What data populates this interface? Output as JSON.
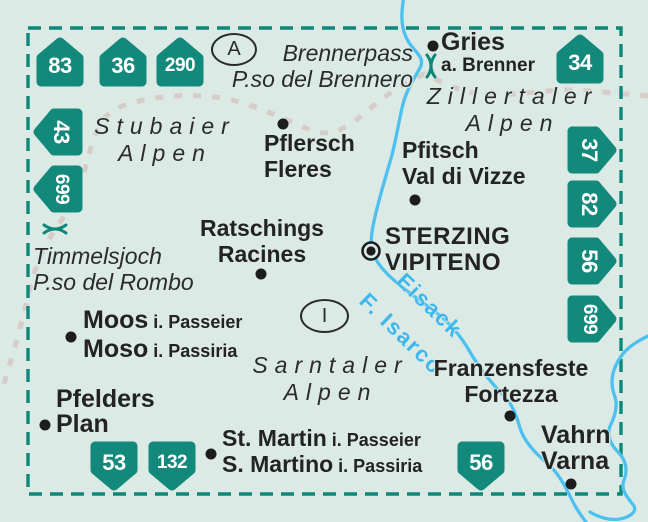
{
  "map_type": "kompass-sheet-overview-map",
  "colors": {
    "background": "#dceae6",
    "badge_green": "#12897b",
    "border_teal": "#0e8678",
    "river_blue": "#4cc1ef",
    "river_label_blue": "#3db7ec",
    "ridge_gray": "#d7cdc8",
    "text_dark": "#232323"
  },
  "badges": [
    {
      "number": "83"
    },
    {
      "number": "36"
    },
    {
      "number": "290"
    },
    {
      "number": "34"
    },
    {
      "number": "43"
    },
    {
      "number": "699"
    },
    {
      "number": "37"
    },
    {
      "number": "82"
    },
    {
      "number": "56"
    },
    {
      "number": "699"
    },
    {
      "number": "53"
    },
    {
      "number": "132"
    },
    {
      "number": "56"
    }
  ],
  "country_markers": {
    "austria": "A",
    "italy": "I"
  },
  "mountain_ranges": {
    "stubaier": {
      "line1": "Stubaier",
      "line2": "Alpen"
    },
    "zillertaler": {
      "line1": "Zillertaler",
      "line2": "Alpen"
    },
    "sarntaler": {
      "line1": "Sarntaler",
      "line2": "Alpen"
    }
  },
  "passes": {
    "brenner": {
      "line1": "Brennerpass",
      "line2": "P.so del Brennero"
    },
    "timmelsjoch": {
      "line1": "Timmelsjoch",
      "line2": "P.so del Rombo"
    }
  },
  "rivers": {
    "name_de": "Eisack",
    "name_it": "F. Isarco"
  },
  "places": {
    "gries": {
      "line1": "Gries",
      "line2": "a. Brenner"
    },
    "pflersch": {
      "line1": "Pflersch",
      "line2": "Fleres"
    },
    "pfitsch": {
      "line1": "Pfitsch",
      "line2": "Val di Vizze"
    },
    "ratschings": {
      "line1": "Ratschings",
      "line2": "Racines"
    },
    "sterzing": {
      "line1": "STERZING",
      "line2": "VIPITENO"
    },
    "moos": {
      "line1_main": "Moos",
      "line1_suffix": "i. Passeier",
      "line2_main": "Moso",
      "line2_suffix": "i. Passiria"
    },
    "pfelders": {
      "line1": "Pfelders",
      "line2": "Plan"
    },
    "st_martin": {
      "line1_main": "St. Martin",
      "line1_suffix": "i. Passeier",
      "line2_main": "S. Martino",
      "line2_suffix": "i. Passiria"
    },
    "franzensfeste": {
      "line1": "Franzensfeste",
      "line2": "Fortezza"
    },
    "vahrn": {
      "line1": "Vahrn",
      "line2": "Varna"
    }
  }
}
